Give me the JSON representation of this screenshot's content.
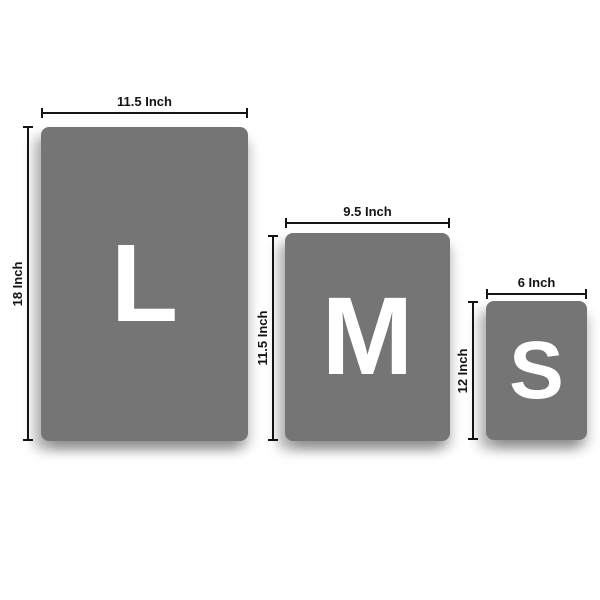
{
  "palette": {
    "page_background": "#ffffff",
    "board_fill": "#757575",
    "letter_color": "#ffffff",
    "dimension_color": "#141414"
  },
  "sizes": [
    {
      "letter": "L",
      "width_inches": 11.5,
      "height_inches": 18,
      "width_label": "11.5 Inch",
      "height_label": "18 Inch"
    },
    {
      "letter": "M",
      "width_inches": 9.5,
      "height_inches": 11.5,
      "width_label": "9.5 Inch",
      "height_label": "11.5 Inch"
    },
    {
      "letter": "S",
      "width_inches": 6,
      "height_inches": 12,
      "width_label": "6 Inch",
      "height_label": "12 Inch"
    }
  ]
}
